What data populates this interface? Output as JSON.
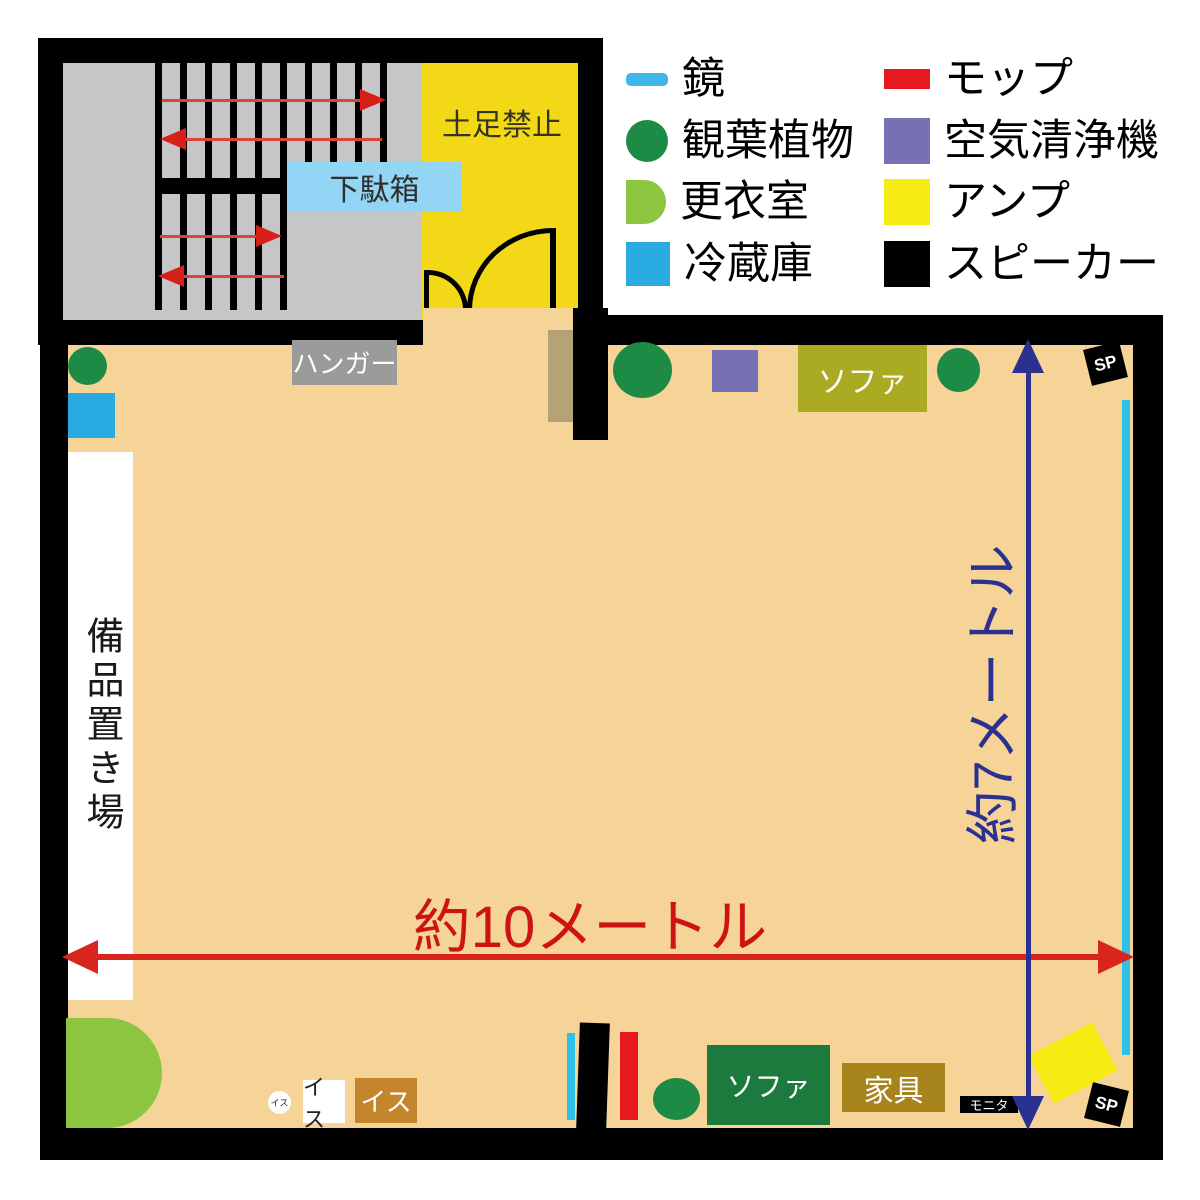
{
  "legend": {
    "items": [
      {
        "label": "鏡",
        "icon": "mirror",
        "color": "#3eb7e8"
      },
      {
        "label": "観葉植物",
        "icon": "plant",
        "color": "#1d8b45"
      },
      {
        "label": "更衣室",
        "icon": "changing-room",
        "color": "#8cc640"
      },
      {
        "label": "冷蔵庫",
        "icon": "refrigerator",
        "color": "#29abe2"
      },
      {
        "label": "モップ",
        "icon": "mop",
        "color": "#e6191e"
      },
      {
        "label": "空気清浄機",
        "icon": "air-purifier",
        "color": "#7671b5"
      },
      {
        "label": "アンプ",
        "icon": "amp",
        "color": "#f6ec13"
      },
      {
        "label": "スピーカー",
        "icon": "speaker",
        "color": "#000000"
      }
    ]
  },
  "entrance": {
    "no_shoes_zone_label": "土足禁止",
    "shoe_cabinet_label": "下駄箱"
  },
  "room": {
    "floor_color": "#f6d396",
    "hanger_label": "ハンガー",
    "equipment_storage_label": "備品置き場",
    "sofa_top_label": "ソファ",
    "sofa_bottom_label": "ソファ",
    "furniture_label": "家具",
    "monitor_label": "モニタ",
    "chair_small_round_label": "イス",
    "chair_white_label": "イス",
    "chair_brown_label": "イス",
    "speaker_top_label": "SP",
    "speaker_bottom_label": "SP"
  },
  "dimensions": {
    "width_label": "約10メートル",
    "width_color": "#cc1414",
    "height_label": "約7メートル",
    "height_color": "#2b3191"
  }
}
